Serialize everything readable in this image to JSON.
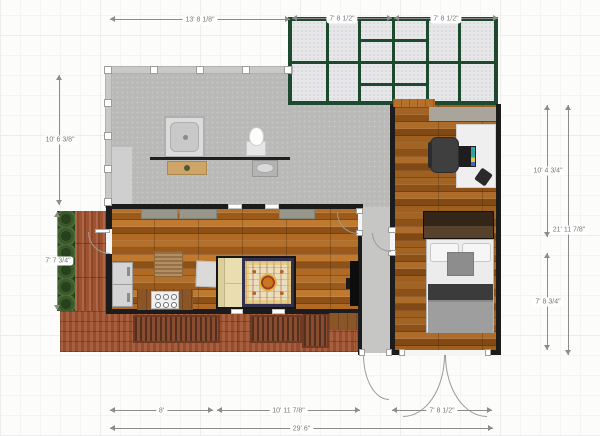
{
  "title": "floor-plan-canvas",
  "dimensions": {
    "top_main": "13' 8 1/8\"",
    "conservatory_left": "7' 8 1/2\"",
    "conservatory_right": "7' 8 1/2\"",
    "left_upper": "10' 6 3/8\"",
    "left_lower": "7' 7 3/4\"",
    "right_upper": "10' 4 3/4\"",
    "right_overall": "21' 11 7/8\"",
    "right_lower": "7' 8 3/4\"",
    "bottom_left": "8'",
    "bottom_center": "10' 11 7/8\"",
    "bottom_right": "7' 8 1/2\"",
    "bottom_overall": "29' 6\""
  },
  "rooms": [
    "bathroom",
    "living-kitchen",
    "bedroom-office",
    "hallway",
    "conservatory",
    "deck",
    "hedge"
  ],
  "furniture": [
    "shower",
    "toilet",
    "sink",
    "vanity",
    "bathroom-counter",
    "closet",
    "fridge",
    "stove",
    "kitchen-counter",
    "dining-table",
    "floor-pad",
    "sofa",
    "rug",
    "tv",
    "desk",
    "office-chair",
    "laptop",
    "phone",
    "wardrobe",
    "bed",
    "pillows",
    "deck-benches"
  ],
  "colors": {
    "wall": "#1c1c1c",
    "conservatory_frame": "#1d4a2e",
    "conservatory_glass": "#e7e7e9",
    "bathroom_floor": "#b9b9b8",
    "hallway_floor": "#c6c6c5",
    "wood_floor": "#a2601f",
    "deck_wood": "#a0522f",
    "hedge_green": "#41632f",
    "dimension_line": "#8c8c8c",
    "dimension_text": "#777777"
  }
}
